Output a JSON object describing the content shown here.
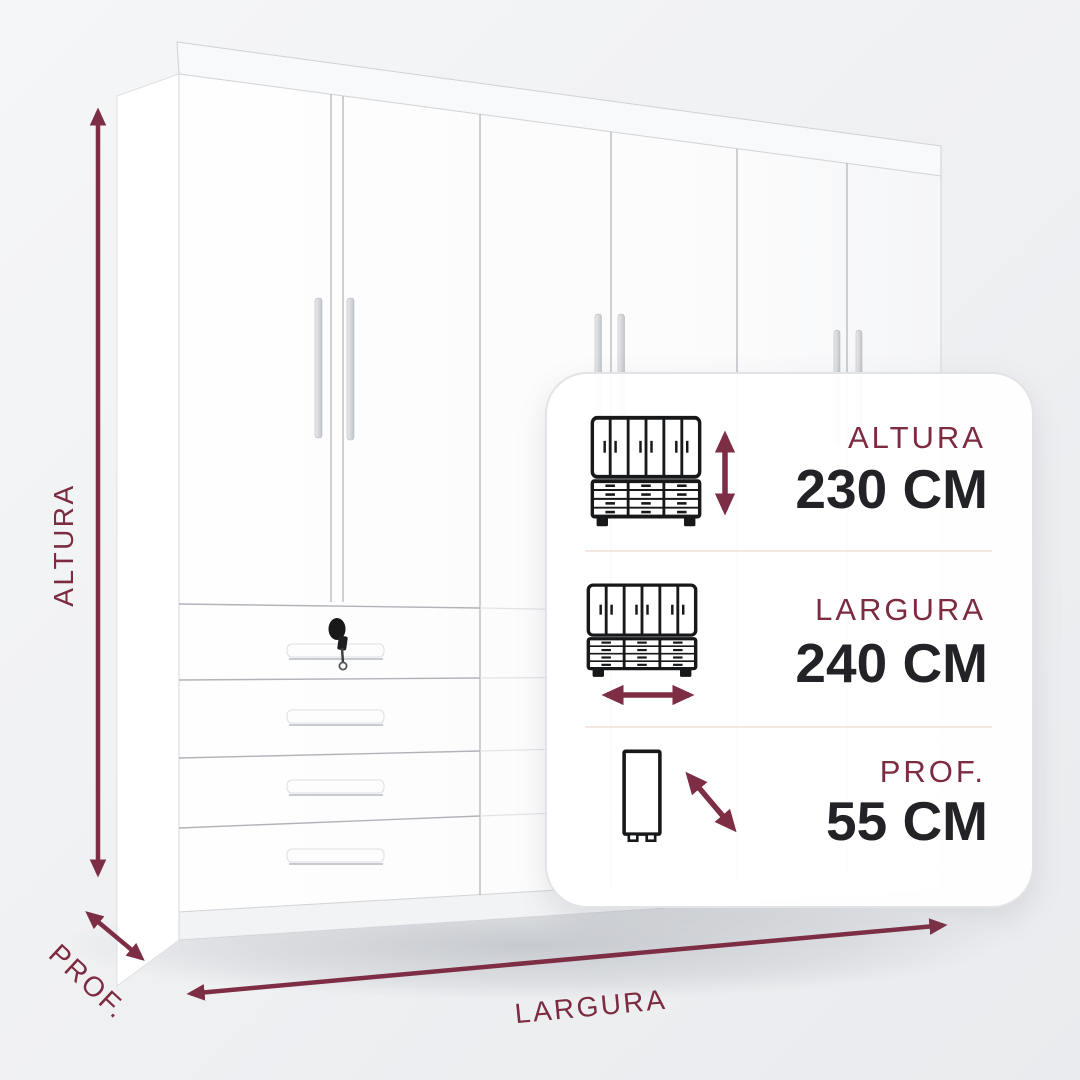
{
  "scene": {
    "altura_axis_label": "ALTURA",
    "largura_axis_label": "LARGURA",
    "prof_axis_label": "PROF."
  },
  "card": {
    "rows": [
      {
        "label": "ALTURA",
        "value": "230 CM",
        "icon": "wardrobe-front-height-icon"
      },
      {
        "label": "LARGURA",
        "value": "240 CM",
        "icon": "wardrobe-front-width-icon"
      },
      {
        "label": "PROF.",
        "value": "55 CM",
        "icon": "wardrobe-side-depth-icon"
      }
    ]
  },
  "icons": {
    "row1_arrow": "vertical-double-arrow-icon",
    "row2_arrow": "horizontal-double-arrow-icon",
    "row3_arrow": "diagonal-double-arrow-icon"
  },
  "colors": {
    "accent_maroon": "#7d2e44",
    "label_maroon": "#7c2b40",
    "value_dark": "#232227",
    "card_border": "#e2e3e6",
    "separator": "#f4e7df",
    "background": "#eff0f2",
    "icon_stroke": "#17181a"
  }
}
